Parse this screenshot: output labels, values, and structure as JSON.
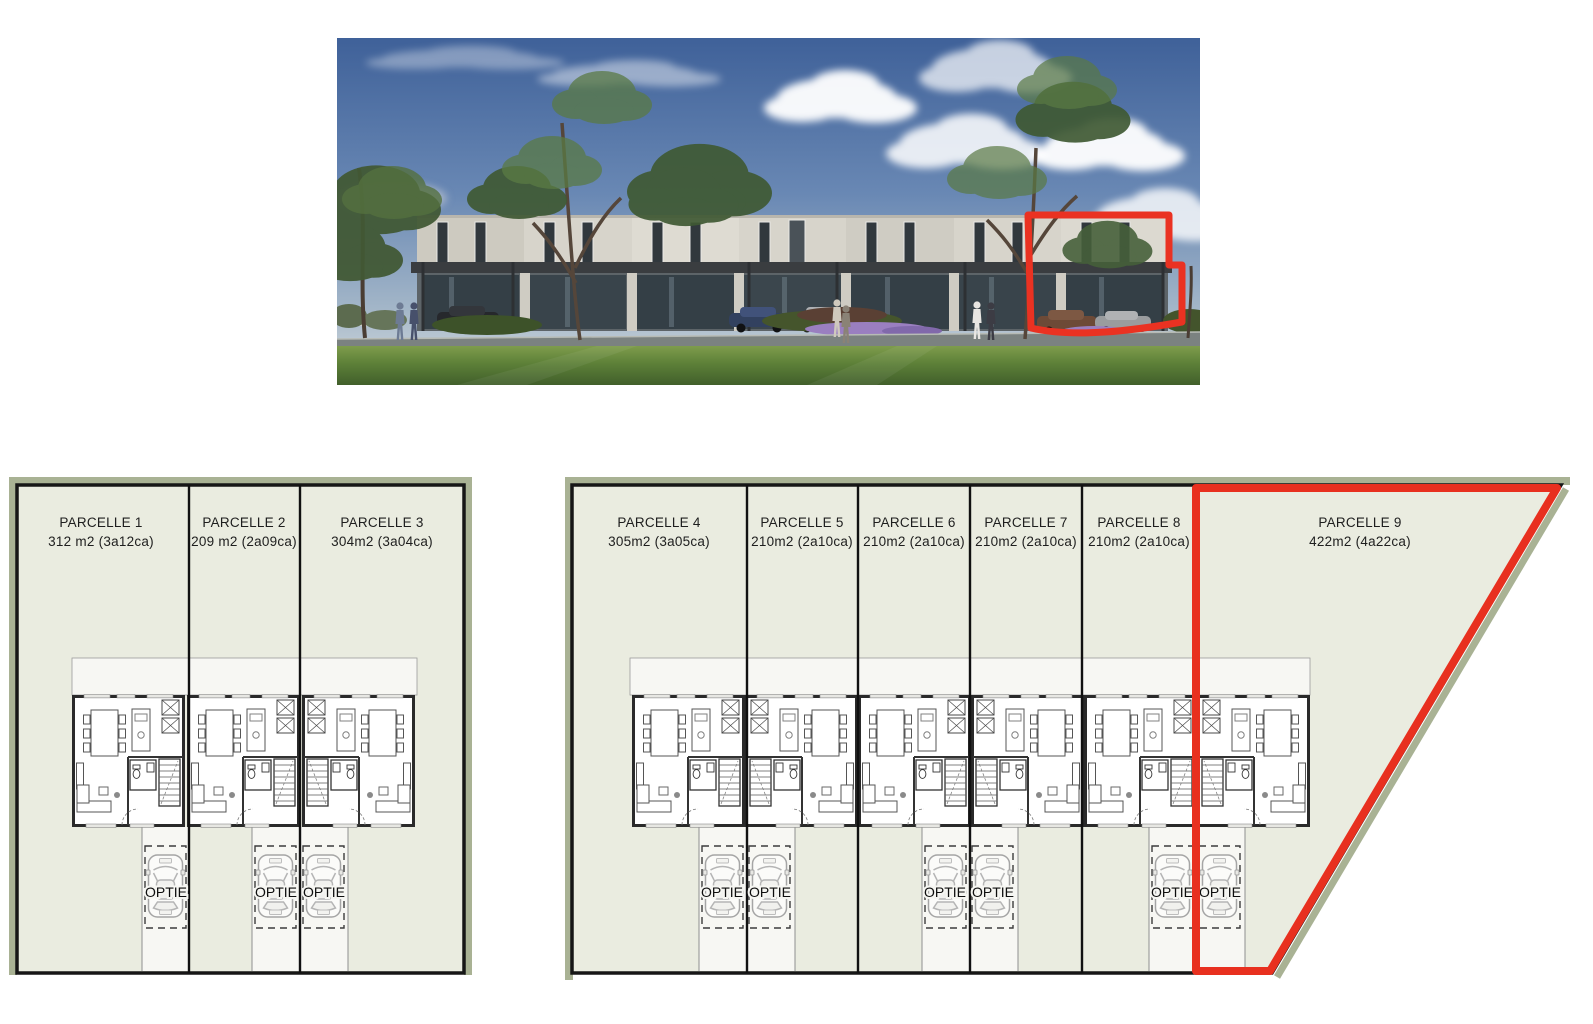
{
  "photo": {
    "description": "street render of modern two-storey row houses with carports, trees and lawn",
    "highlight_color": "#ea3222"
  },
  "site_plans": {
    "surface_color": "#eaece0",
    "driveway_color": "#f7f7f3",
    "edge_color": "#a9b294",
    "line_color": "#161616",
    "highlight_color": "#e8301f",
    "carport_option_label": "OPTIE",
    "left_plan": {
      "parcels": [
        {
          "name": "PARCELLE 1",
          "area": "312 m2 (3a12ca)"
        },
        {
          "name": "PARCELLE 2",
          "area": "209 m2 (2a09ca)"
        },
        {
          "name": "PARCELLE 3",
          "area": "304m2 (3a04ca)"
        }
      ]
    },
    "right_plan": {
      "parcels": [
        {
          "name": "PARCELLE 4",
          "area": "305m2 (3a05ca)"
        },
        {
          "name": "PARCELLE 5",
          "area": "210m2 (2a10ca)"
        },
        {
          "name": "PARCELLE 6",
          "area": "210m2 (2a10ca)"
        },
        {
          "name": "PARCELLE 7",
          "area": "210m2 (2a10ca)"
        },
        {
          "name": "PARCELLE 8",
          "area": "210m2 (2a10ca)"
        },
        {
          "name": "PARCELLE 9",
          "area": "422m2 (4a22ca)",
          "highlighted": true
        }
      ]
    }
  }
}
